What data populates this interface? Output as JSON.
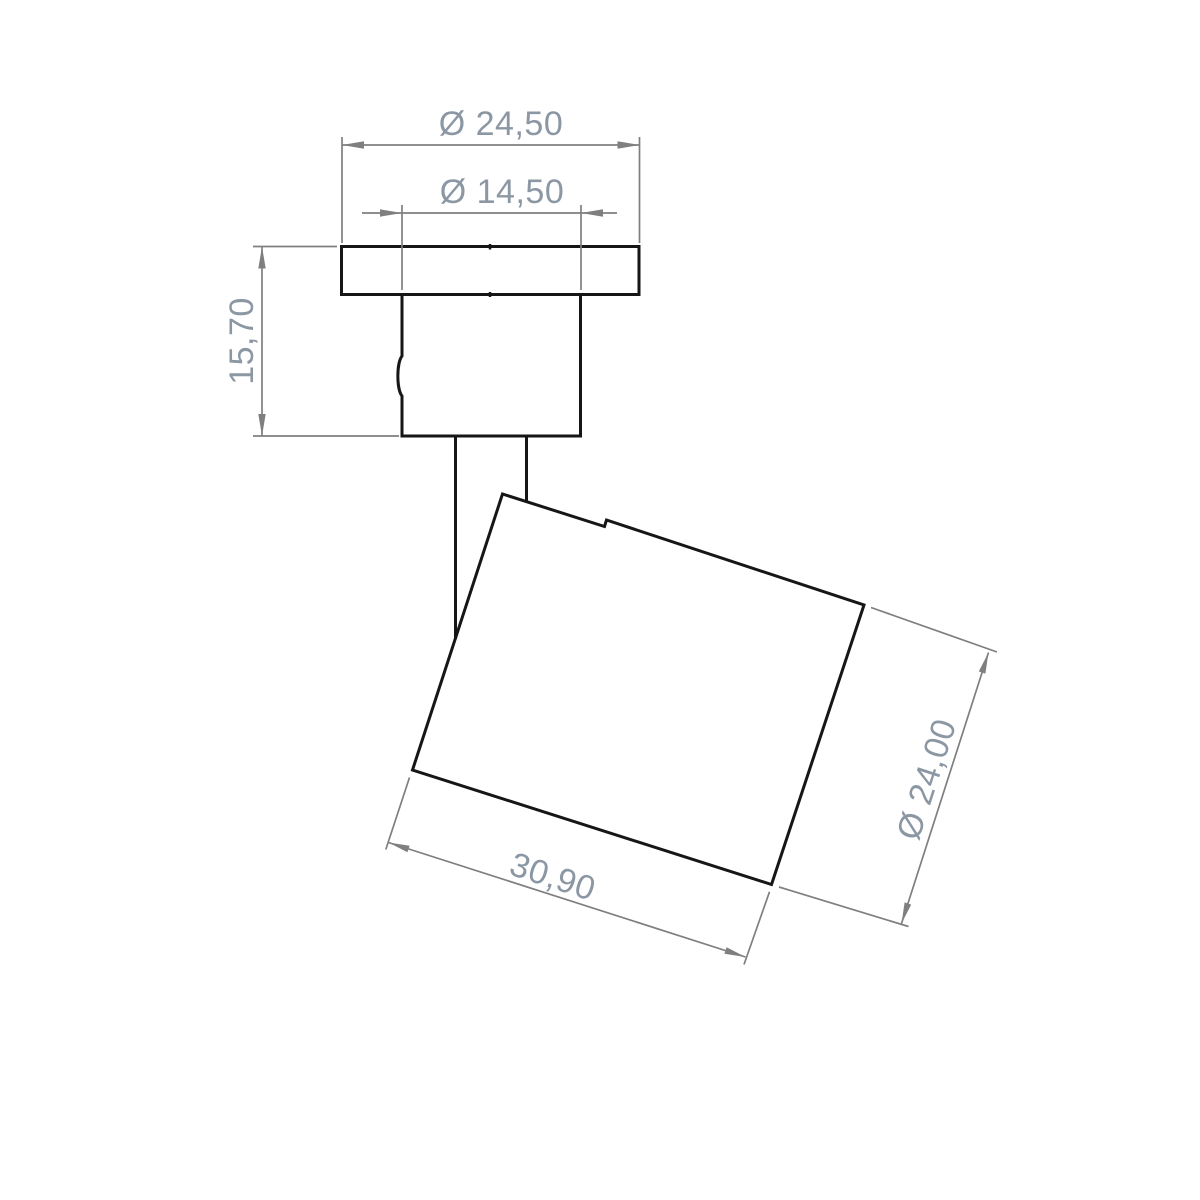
{
  "drawing": {
    "kind": "technical-dimension-drawing",
    "background_color": "#ffffff",
    "outline_color": "#161616",
    "dimension_line_color": "#7f7f7f",
    "dimension_text_color": "#8c97a4",
    "dimensions": {
      "flange_diameter": {
        "label": "Ø 24,50",
        "symbol": "Ø",
        "value": "24,50",
        "kind": "diameter"
      },
      "neck_diameter": {
        "label": "Ø 14,50",
        "symbol": "Ø",
        "value": "14,50",
        "kind": "diameter"
      },
      "mount_height": {
        "label": "15,70",
        "value": "15,70",
        "kind": "linear"
      },
      "head_length": {
        "label": "30,90",
        "value": "30,90",
        "kind": "linear"
      },
      "head_diameter": {
        "label": "Ø 24,00",
        "symbol": "Ø",
        "value": "24,00",
        "kind": "diameter"
      }
    }
  }
}
